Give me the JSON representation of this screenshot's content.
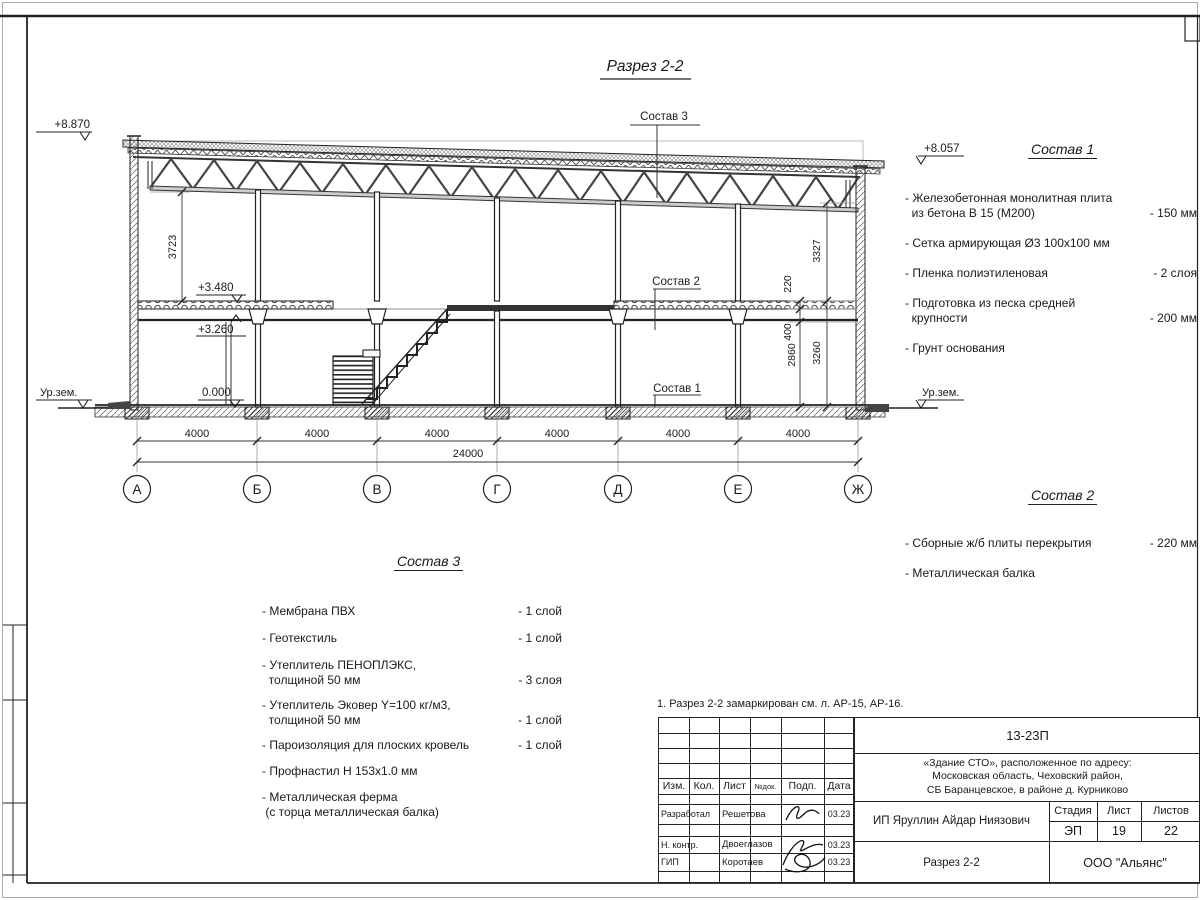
{
  "drawing": {
    "title": "Разрез 2-2",
    "axes": [
      "А",
      "Б",
      "В",
      "Г",
      "Д",
      "Е",
      "Ж"
    ],
    "span_dim": "4000",
    "total_dim": "24000",
    "elevations": {
      "roof_left": "+8.870",
      "roof_right": "+8.057",
      "slab_top": "+3.480",
      "beam": "+3.260",
      "floor": "0.000",
      "ground": "Ур.зем."
    },
    "vertical_dims": {
      "left_height": "3723",
      "right_height": "3327",
      "slab": "220",
      "beam": "400",
      "clear": "2860",
      "storey": "3260"
    },
    "callouts": {
      "c1": "Состав 1",
      "c2": "Состав 2",
      "c3": "Состав 3"
    }
  },
  "compositions": [
    {
      "heading": "Состав 1",
      "items": [
        {
          "name": "- Железобетонная  монолитная плита\n  из бетона В 15 (М200)",
          "value": "- 150 мм"
        },
        {
          "name": "- Сетка армирующая Ø3 100х100 мм",
          "value": ""
        },
        {
          "name": "- Пленка полиэтиленовая",
          "value": "- 2 слоя"
        },
        {
          "name": "- Подготовка из песка средней\n  крупности",
          "value": "- 200 мм"
        },
        {
          "name": "- Грунт основания",
          "value": ""
        }
      ]
    },
    {
      "heading": "Состав 2",
      "items": [
        {
          "name": "- Сборные ж/б плиты перекрытия",
          "value": "- 220 мм"
        },
        {
          "name": "- Металлическая  балка",
          "value": ""
        }
      ]
    },
    {
      "heading": "Состав 3",
      "items": [
        {
          "name": "- Мембрана ПВХ",
          "value": "- 1 слой"
        },
        {
          "name": "- Геотекстиль",
          "value": "- 1 слой"
        },
        {
          "name": "- Утеплитель ПЕНОПЛЭКС,\n  толщиной 50 мм",
          "value": "- 3 слоя"
        },
        {
          "name": "- Утеплитель Эковер Y=100 кг/м3,\n  толщиной 50 мм",
          "value": "- 1 слой"
        },
        {
          "name": "- Пароизоляция для плоских кровель",
          "value": "- 1 слой"
        },
        {
          "name": "- Профнастил Н 153х1.0 мм",
          "value": ""
        },
        {
          "name": "- Металлическая ферма\n (с торца металлическая балка)",
          "value": ""
        }
      ]
    }
  ],
  "note": "1. Разрез 2-2 замаркирован см. л. АР-15, АР-16.",
  "title_block": {
    "code": "13-23П",
    "object": "«Здание СТО», расположенное по адресу:\nМосковская область, Чеховский район,\nСБ Баранцевское, в районе д. Курниково",
    "cols": [
      "Изм.",
      "Кол.",
      "Лист",
      "№док.",
      "Подп.",
      "Дата"
    ],
    "rows": [
      {
        "role": "Разработал",
        "name": "Решетова",
        "date": "03.23"
      },
      {
        "role": "Н. контр.",
        "name": "Двоеглазов",
        "date": "03.23"
      },
      {
        "role": "ГИП",
        "name": "Коротаев",
        "date": "03.23"
      }
    ],
    "client": "ИП Яруллин Айдар Ниязович",
    "stage_label": "Стадия",
    "sheet_label": "Лист",
    "sheets_label": "Листов",
    "stage": "ЭП",
    "sheet": "19",
    "sheets": "22",
    "doc_title": "Разрез 2-2",
    "company": "ООО \"Альянс\""
  }
}
